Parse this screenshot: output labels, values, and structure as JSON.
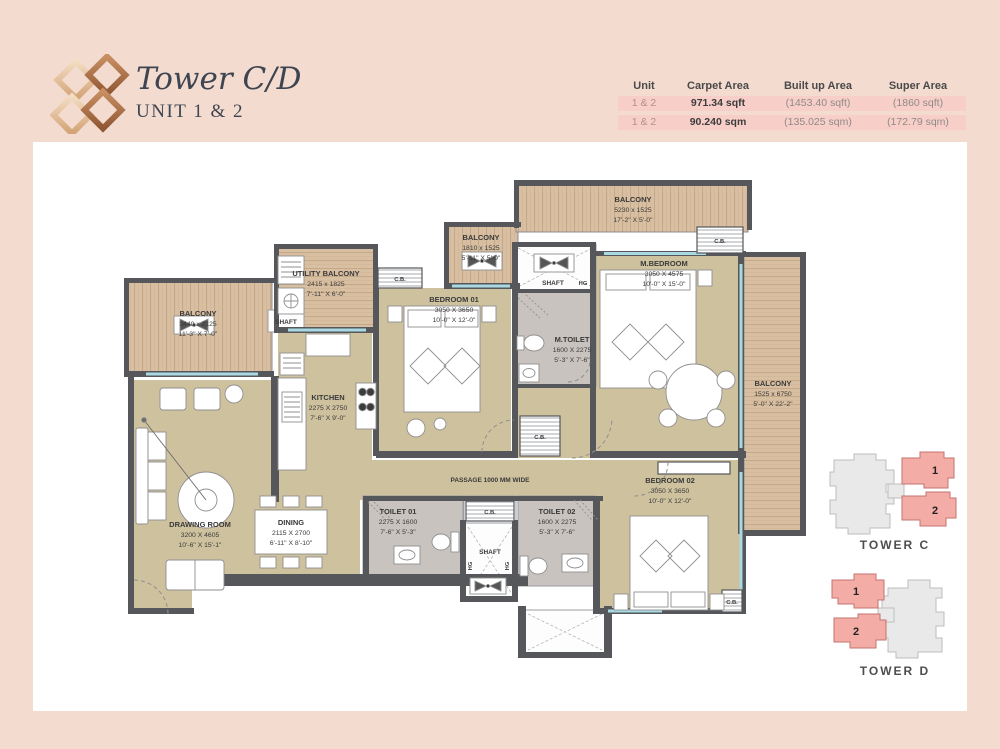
{
  "header": {
    "title": "Tower C/D",
    "subtitle": "UNIT 1 & 2"
  },
  "area_table": {
    "headers": [
      "Unit",
      "Carpet Area",
      "Built up Area",
      "Super Area"
    ],
    "rows": [
      {
        "unit": "1 & 2",
        "carpet": "971.34 sqft",
        "built_up": "(1453.40 sqft)",
        "super": "(1860 sqft)"
      },
      {
        "unit": "1 & 2",
        "carpet": "90.240 sqm",
        "built_up": "(135.025 sqm)",
        "super": "(172.79 sqm)"
      }
    ]
  },
  "plan": {
    "rooms": [
      {
        "name": "BALCONY",
        "mm": "3440 x 2125",
        "ft": "11'-3\" X 7'-0\""
      },
      {
        "name": "UTILITY BALCONY",
        "mm": "2415 x 1825",
        "ft": "7'-11\" X 6'-0\""
      },
      {
        "name": "BALCONY",
        "mm": "1810 x 1525",
        "ft": "5'-11\" X 5'-0\""
      },
      {
        "name": "BALCONY",
        "mm": "5230 x 1525",
        "ft": "17'-2\" X 5'-0\""
      },
      {
        "name": "BALCONY",
        "mm": "1525 x 6750",
        "ft": "5'-0\" X 22'-2\""
      },
      {
        "name": "KITCHEN",
        "mm": "2275 X 2750",
        "ft": "7'-6\" X 9'-0\""
      },
      {
        "name": "BEDROOM 01",
        "mm": "3050 X 3650",
        "ft": "10'-0\" X 12'-0\""
      },
      {
        "name": "M.BEDROOM",
        "mm": "3050 X 4575",
        "ft": "10'-0\" X 15'-0\""
      },
      {
        "name": "M.TOILET",
        "mm": "1600 X 2275",
        "ft": "5'-3\" X 7'-6\""
      },
      {
        "name": "DRAWING ROOM",
        "mm": "3200 X 4605",
        "ft": "10'-6\" X 15'-1\""
      },
      {
        "name": "DINING",
        "mm": "2115 X 2700",
        "ft": "6'-11\" X 8'-10\""
      },
      {
        "name": "TOILET 01",
        "mm": "2275 X 1600",
        "ft": "7'-6\" X 5'-3\""
      },
      {
        "name": "TOILET 02",
        "mm": "1600 X 2275",
        "ft": "5'-3\" X 7'-6\""
      },
      {
        "name": "BEDROOM 02",
        "mm": "3050 X 3650",
        "ft": "10'-0\" X 12'-0\""
      }
    ],
    "labels": {
      "passage": "PASSAGE 1000 MM WIDE",
      "shaft": "SHAFT",
      "hg": "HG",
      "cb": "C.B."
    }
  },
  "key_plans": [
    {
      "label": "TOWER C",
      "units": [
        "1",
        "2"
      ]
    },
    {
      "label": "TOWER D",
      "units": [
        "1",
        "2"
      ]
    }
  ],
  "colors": {
    "page_background": "#f3dbd0",
    "panel": "#ffffff",
    "wall": "#55575b",
    "floor": "#cec19e",
    "wood": "#d8bfa1",
    "toilet_floor": "#c9c3bf",
    "window": "#a9d9e3",
    "row_highlight": "#f8cfc8",
    "unit_highlight": "#f4aca7",
    "keyplan_gray": "#e9e9e9",
    "logo_copper": "#a5683f",
    "logo_light": "#ecd2b4",
    "title_text": "#3e4550"
  }
}
